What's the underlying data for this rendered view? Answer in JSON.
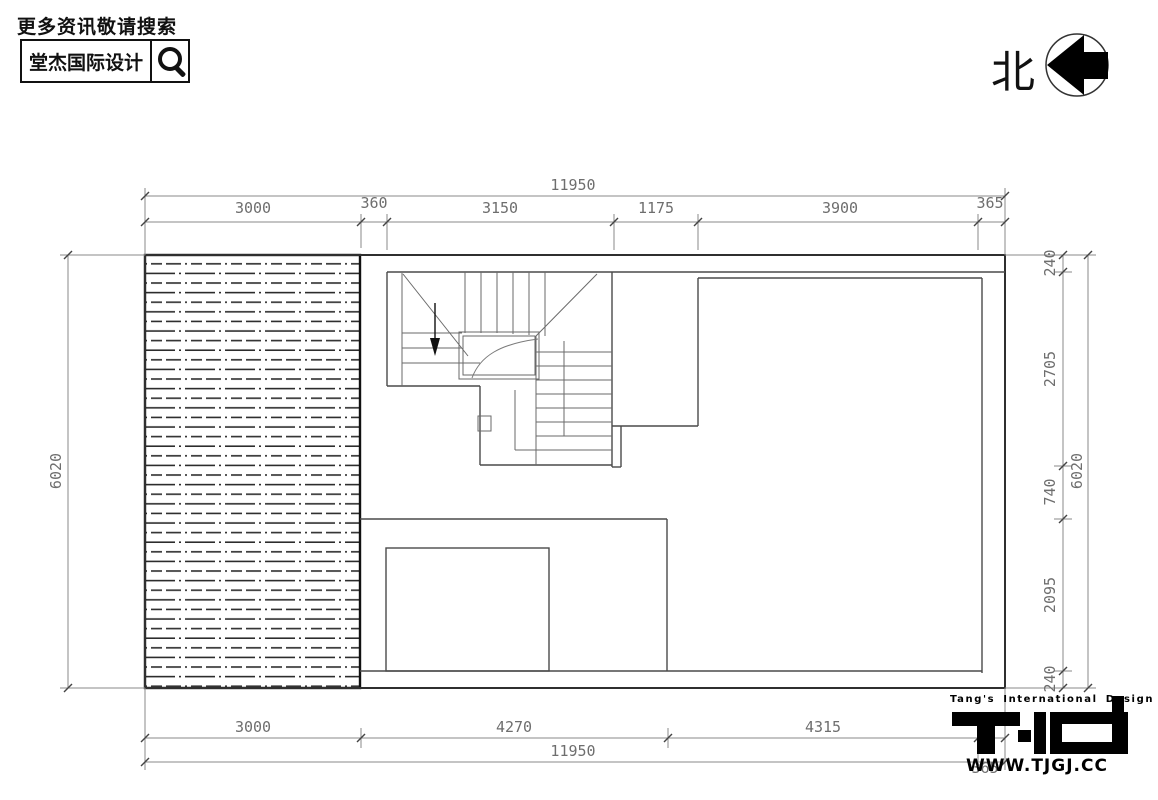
{
  "branding": {
    "search_notice": "更多资讯敬请搜索",
    "logo_box_text": "堂杰国际设计",
    "magnifier_icon": "search-magnifier"
  },
  "north": {
    "label": "北",
    "arrow_icon": "north-arrow-left"
  },
  "footer_logo": {
    "tagline": "Tang's International Design",
    "monogram": "TJD",
    "website": "WWW.TJGJ.CC"
  },
  "dimensions": {
    "top_total": "11950",
    "top_segments": [
      "3000",
      "360",
      "3150",
      "1175",
      "3900",
      "365"
    ],
    "bottom_segments": [
      "3000",
      "4270",
      "4315",
      "365"
    ],
    "bottom_total": "11950",
    "left_total": "6020",
    "right_segments": [
      "240",
      "2705",
      "740",
      "2095",
      "240"
    ],
    "right_total": "6020"
  },
  "drawing": {
    "type": "floor-plan",
    "features": [
      "hatched-roof-area",
      "u-shaped-stair-with-down-arrow",
      "rooms",
      "dimension-chains"
    ],
    "line_color": "#3a3a3a",
    "dim_color": "#8a8a8a"
  }
}
